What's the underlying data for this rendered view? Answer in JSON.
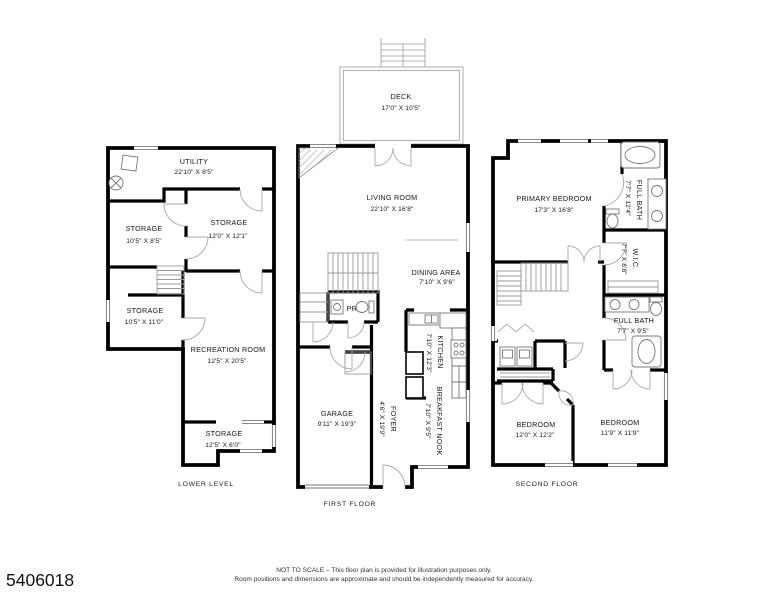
{
  "colors": {
    "wall": "#000000",
    "thin_line": "#999999",
    "text": "#151515"
  },
  "floors": [
    {
      "label": "LOWER LEVEL",
      "rooms": [
        {
          "name": "UTILITY",
          "dims": "22'10\" X 8'5\""
        },
        {
          "name": "STORAGE",
          "dims": "10'5\" X 8'5\""
        },
        {
          "name": "STORAGE",
          "dims": "12'0\" X 12'1\""
        },
        {
          "name": "STORAGE",
          "dims": "10'5\" X 11'0\""
        },
        {
          "name": "RECREATION ROOM",
          "dims": "12'5\" X 20'5\""
        },
        {
          "name": "STORAGE",
          "dims": "12'5\" X 6'0\""
        }
      ]
    },
    {
      "label": "FIRST FLOOR",
      "rooms": [
        {
          "name": "DECK",
          "dims": "17'0\" X 10'5\""
        },
        {
          "name": "LIVING ROOM",
          "dims": "22'10\" X 16'8\""
        },
        {
          "name": "DINING AREA",
          "dims": "7'10\" X 9'6\""
        },
        {
          "name": "PR"
        },
        {
          "name": "KITCHEN",
          "dims": "7'10\" X 12'3\""
        },
        {
          "name": "FOYER",
          "dims": "4'6\" X 19'9\""
        },
        {
          "name": "BREAKFAST NOOK",
          "dims": "7'10\" X 9'5\""
        },
        {
          "name": "GARAGE",
          "dims": "9'11\" X 19'3\""
        }
      ]
    },
    {
      "label": "SECOND FLOOR",
      "rooms": [
        {
          "name": "PRIMARY BEDROOM",
          "dims": "17'3\" X 16'8\""
        },
        {
          "name": "FULL BATH",
          "dims": "7'7\" X 12'4\""
        },
        {
          "name": "W.I.C.",
          "dims": "7'7\" X 8'8\""
        },
        {
          "name": "FULL BATH",
          "dims": "7'7\" X 9'5\""
        },
        {
          "name": "BEDROOM",
          "dims": "12'0\" X 12'2\""
        },
        {
          "name": "BEDROOM",
          "dims": "11'9\" X 11'9\""
        }
      ]
    }
  ],
  "footer": {
    "listing_id": "5406018",
    "disclaimer_line1": "NOT TO SCALE – This floor plan is provided for illustration purposes only.",
    "disclaimer_line2": "Room positions and dimensions are approximate and should be independently measured for accuracy."
  }
}
